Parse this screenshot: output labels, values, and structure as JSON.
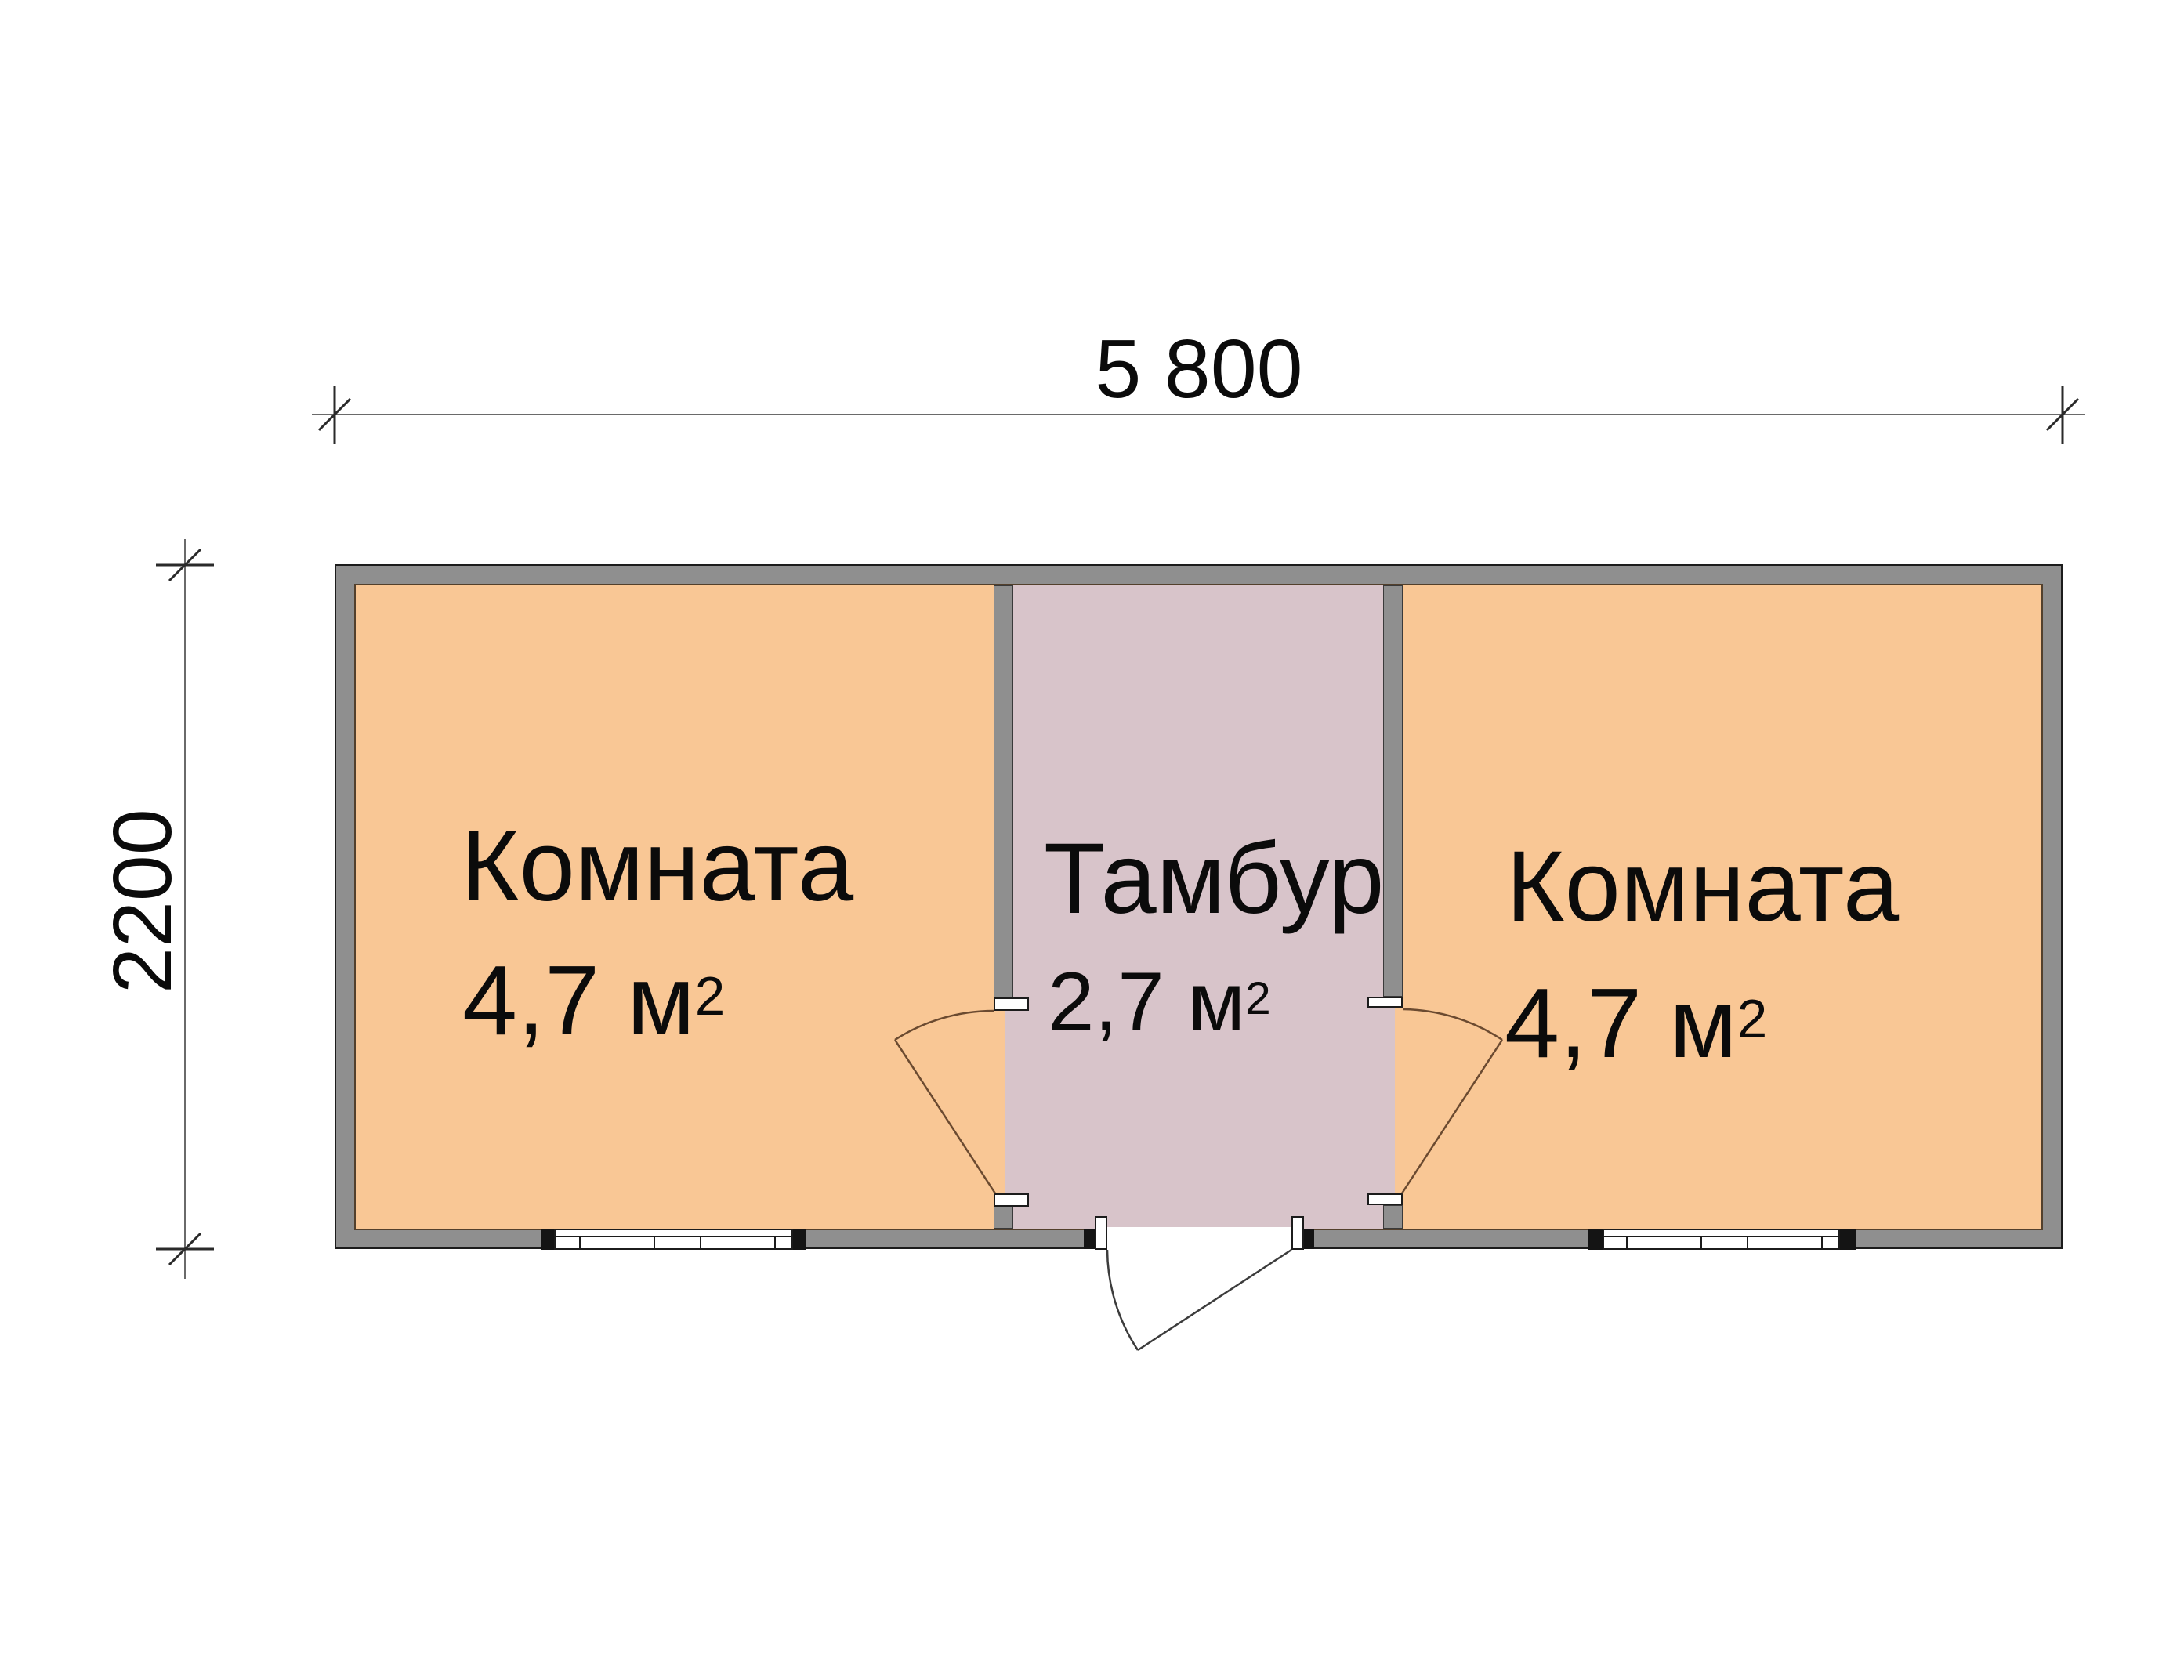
{
  "dimensions": {
    "top_label": "5 800",
    "left_label": "2200"
  },
  "rooms": {
    "left": {
      "name": "Комната",
      "area": "4,7 м",
      "area_sup": "2"
    },
    "tambour": {
      "name": "Тамбур",
      "area": "2,7 м",
      "area_sup": "2"
    },
    "right": {
      "name": "Комната",
      "area": "4,7 м",
      "area_sup": "2"
    }
  },
  "colors": {
    "room_fill": "#f9c795",
    "tambour_fill": "#d8c4ca",
    "wall_fill": "#8f8f8f",
    "outline": "#1c1c1c",
    "floor_edge": "#53402c",
    "interior_door_line": "#6b4a30",
    "entrance_door_line": "#3c3c3c",
    "dim_line": "#6a6a6a",
    "dim_tick": "#2a2a2a",
    "text": "#0b0b0b"
  }
}
